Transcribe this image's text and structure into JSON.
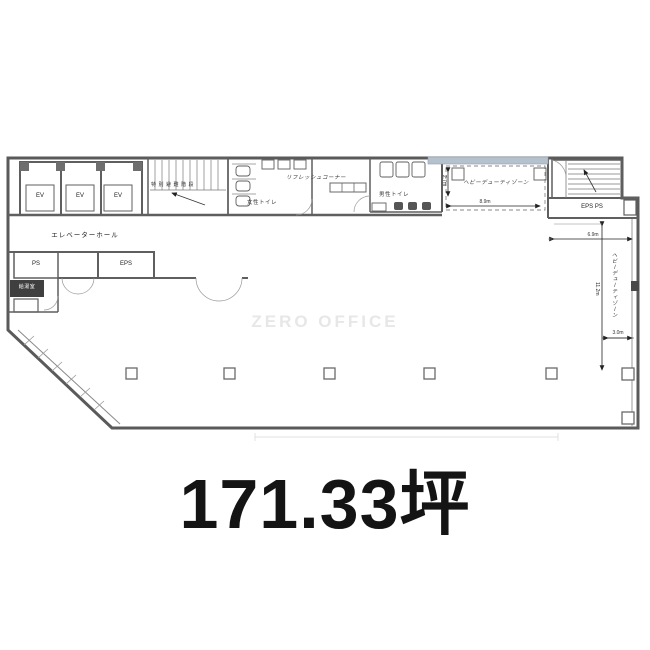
{
  "watermark": "ZERO OFFICE",
  "area_text": "171.33坪",
  "plan": {
    "labels": {
      "ev": "EV",
      "elevator_hall": "エレベーターホール",
      "evac_stairs": "特別避難階段",
      "womens_toilet": "女性トイレ",
      "refresh_corner": "リフレッシュコーナー",
      "mens_toilet": "男性トイレ",
      "heavy_duty_zone": "ヘビーデューティゾーン",
      "heavy_duty_zone_side": "ヘビーデューティゾーン",
      "eps_ps": "EPS PS",
      "ps": "PS",
      "eps": "EPS",
      "pantry": "給湯室"
    },
    "dimensions": {
      "zone_width": "8.9m",
      "zone_depth": "2.7m",
      "right_width": "6.9m",
      "right_depth": "11.2m",
      "right_inset": "3.0m"
    }
  }
}
